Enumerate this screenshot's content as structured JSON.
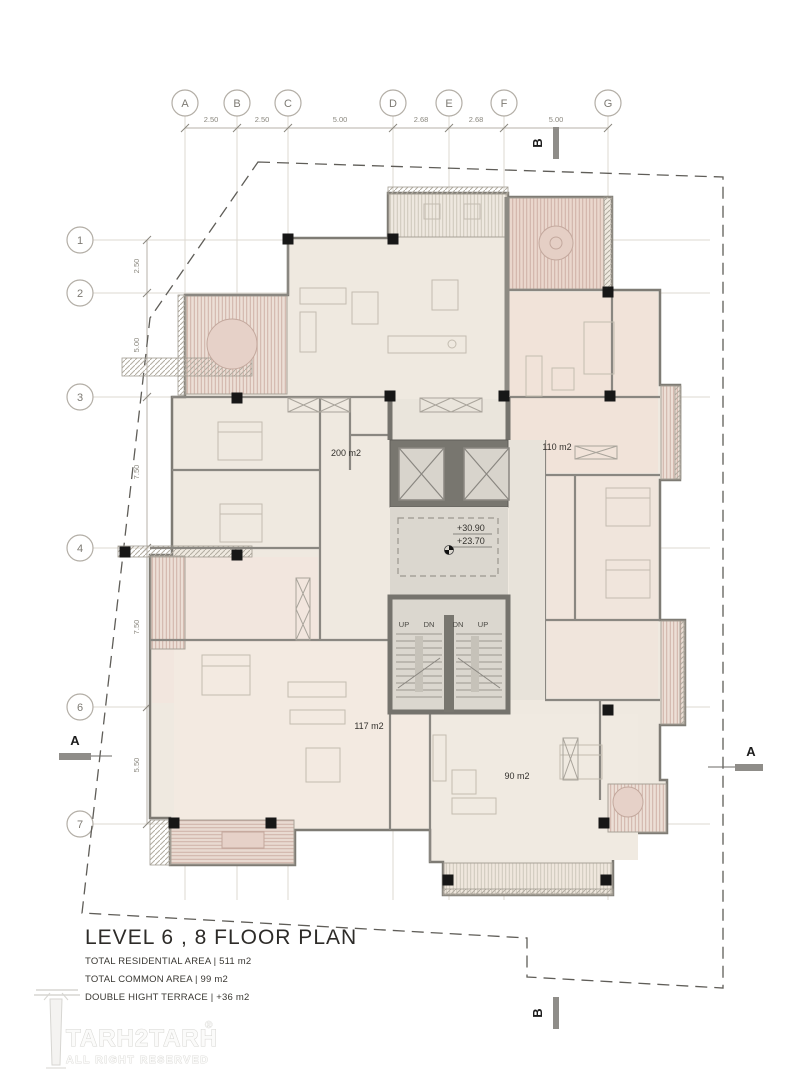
{
  "drawing": {
    "title": "LEVEL 6 , 8  FLOOR PLAN",
    "stats": [
      "TOTAL RESIDENTIAL AREA | 511 m2",
      "TOTAL COMMON AREA | 99 m2",
      "DOUBLE HIGHT TERRACE  | +36 m2"
    ]
  },
  "logo": {
    "name": "TARH2TARH",
    "registered": "®",
    "tagline": "ALL RIGHT RESERVED"
  },
  "grid": {
    "col_labels": [
      "A",
      "B",
      "C",
      "D",
      "E",
      "F",
      "G"
    ],
    "col_dims": [
      "2.50",
      "2.50",
      "5.00",
      "2.68",
      "2.68",
      "5.00"
    ],
    "row_labels": [
      "1",
      "2",
      "3",
      "4",
      "6",
      "7"
    ],
    "row_dims": [
      "2.50",
      "5.00",
      "7.50",
      "7.50",
      "5.50"
    ]
  },
  "rooms": {
    "apt_top": "200 m2",
    "apt_right": "110 m2",
    "apt_left": "117 m2",
    "apt_bottom": "90 m2"
  },
  "levels": {
    "upper": "+30.90",
    "lower": "+23.70"
  },
  "stairs": {
    "up": "UP",
    "dn": "DN"
  },
  "sections": {
    "a": "A",
    "b": "B"
  },
  "colors": {
    "cream": "#efe9e0",
    "pink": "#f1e3d9",
    "terracotta": "#cbaba1",
    "wall": "#85827b",
    "core": "#75736d",
    "column": "#171717"
  }
}
